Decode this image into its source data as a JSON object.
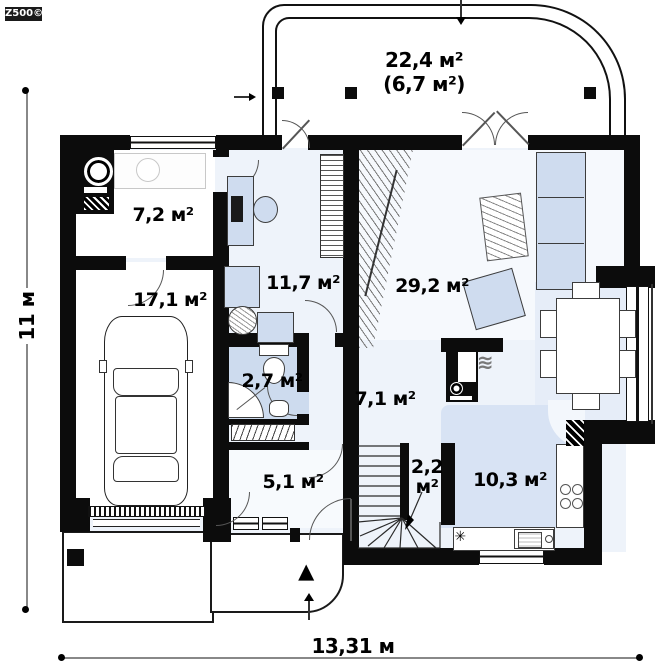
{
  "logo": {
    "text": "Z500©"
  },
  "dimensions": {
    "width": "13,31 м",
    "height": "11 м"
  },
  "rooms": {
    "terrace": {
      "area": "22,4 м²",
      "area_note": "(6,7 м²)"
    },
    "utility": {
      "area": "7,2 м²"
    },
    "garage": {
      "area": "17,1 м²"
    },
    "office": {
      "area": "11,7 м²"
    },
    "living": {
      "area": "29,2 м²"
    },
    "bathroom": {
      "area": "2,7 м²"
    },
    "hall": {
      "area": "7,1 м²"
    },
    "entry": {
      "area": "5,1 м²"
    },
    "stairs": {
      "area": "2,2 м²"
    },
    "kitchen": {
      "area": "10,3 м²"
    }
  },
  "icons": {
    "snowflake": "✳",
    "entrance_marker": "▲",
    "heat_waves": "≋"
  },
  "colors": {
    "wall": "#0c0c0c",
    "floor_light": "#eef3fa",
    "floor_living": "#f6f9fd",
    "floor_dining": "#e6edf8",
    "floor_kitchen": "#d8e3f4",
    "floor_bath": "#cddbee",
    "furniture_blue": "#cfdcef"
  }
}
